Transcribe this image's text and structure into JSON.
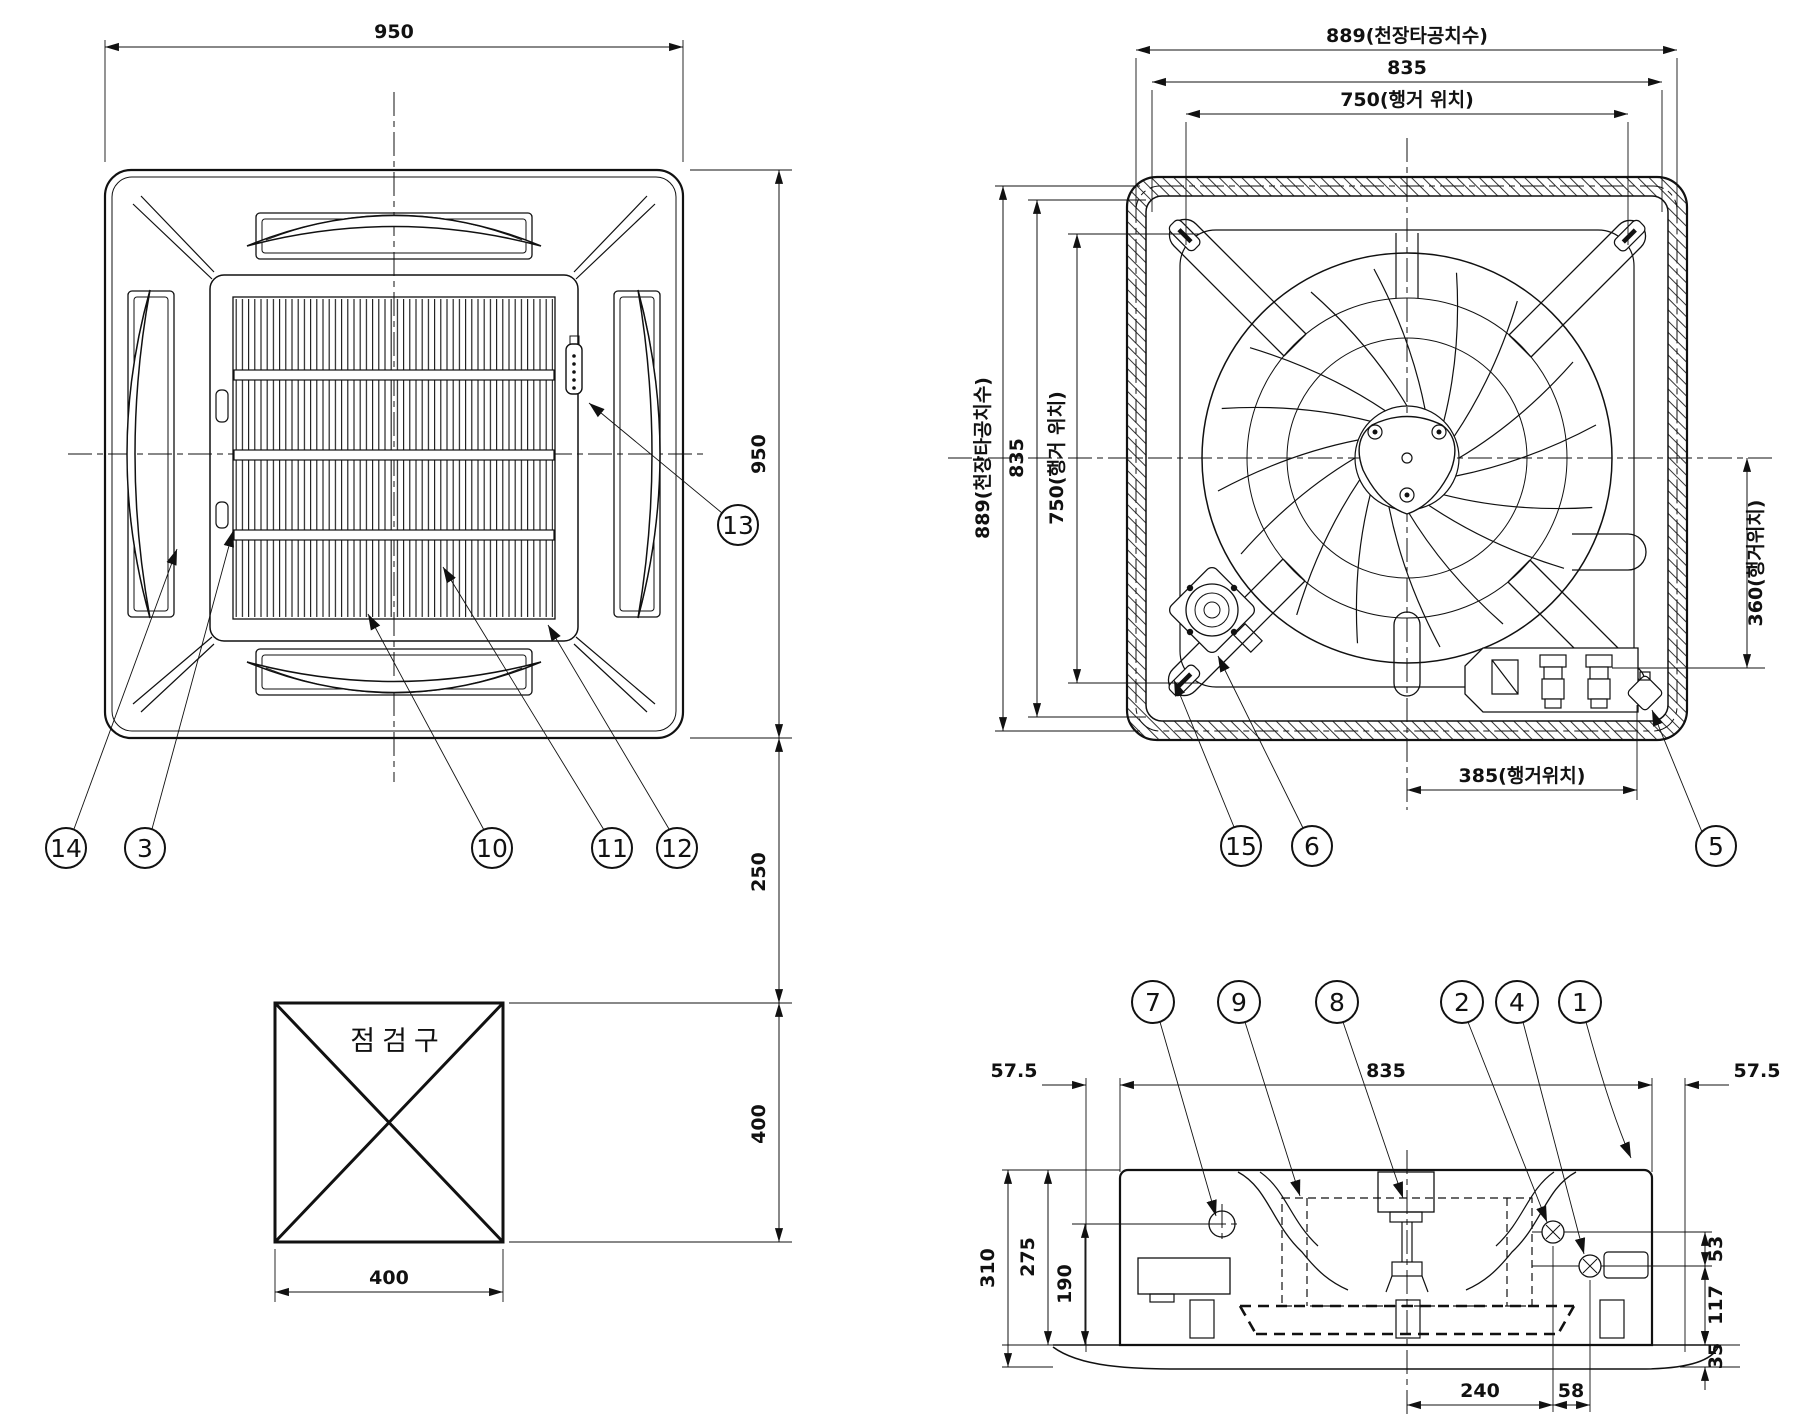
{
  "views": {
    "panel": {
      "dim_width_top": "950",
      "dim_height_right": "950",
      "dim_gap_right": "250",
      "dim_inspection_right": "400",
      "dim_inspection_bottom": "400",
      "inspection_label": "점검구",
      "callouts": {
        "c14": "14",
        "c3": "3",
        "c10": "10",
        "c11": "11",
        "c12": "12",
        "c13": "13"
      }
    },
    "unit_top": {
      "dim_top_889": "889(천장타공치수)",
      "dim_top_835": "835",
      "dim_top_750": "750(행거 위치)",
      "dim_left_889": "889(천장타공치수)",
      "dim_left_835": "835",
      "dim_left_750": "750(행거 위치)",
      "dim_right_360": "360(행거위치)",
      "dim_bottom_385": "385(행거위치)",
      "callouts": {
        "c15": "15",
        "c6": "6",
        "c5": "5"
      }
    },
    "unit_side": {
      "dim_top_left_margin": "57.5",
      "dim_top_width": "835",
      "dim_top_right_margin": "57.5",
      "dim_left_310": "310",
      "dim_left_275": "275",
      "dim_left_190": "190",
      "dim_right_53": "53",
      "dim_right_117": "117",
      "dim_right_35": "35",
      "dim_bottom_240": "240",
      "dim_bottom_58": "58",
      "callouts": {
        "c7": "7",
        "c9": "9",
        "c8": "8",
        "c2": "2",
        "c4": "4",
        "c1": "1"
      }
    }
  }
}
